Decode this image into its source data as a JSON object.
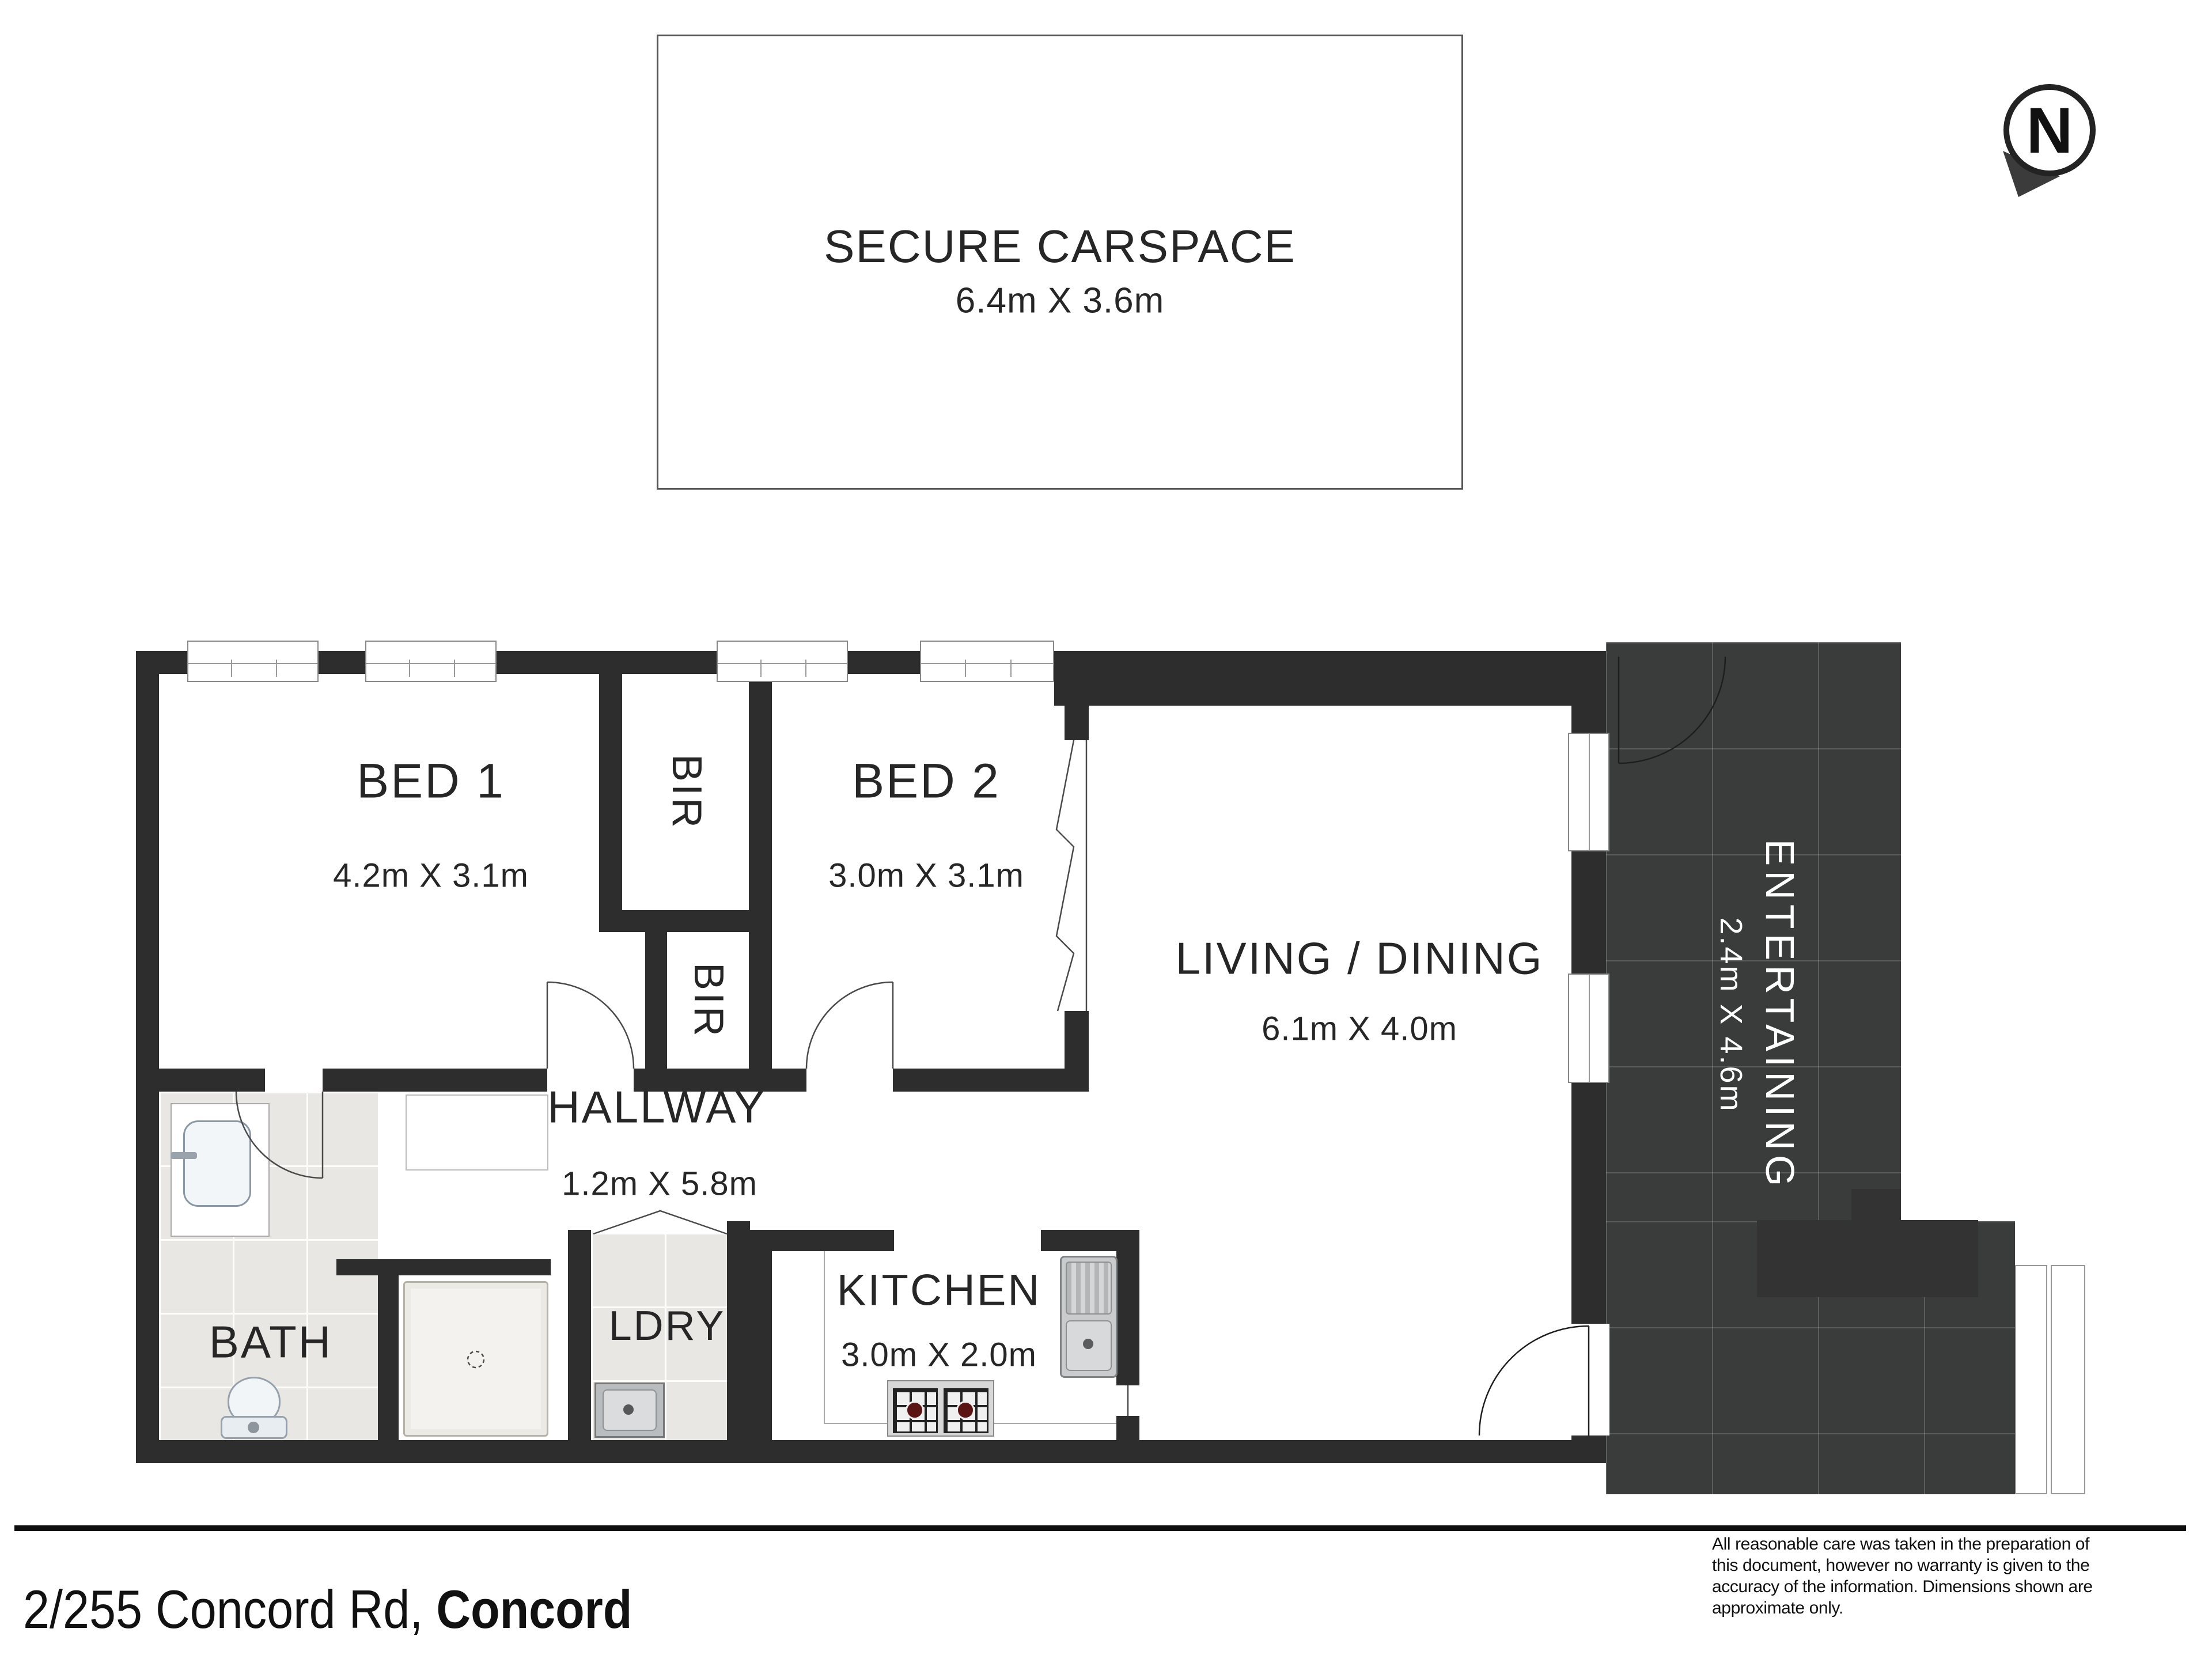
{
  "carspace": {
    "title": "SECURE CARSPACE",
    "dims": "6.4m X 3.6m"
  },
  "compass": {
    "letter": "N"
  },
  "rooms": {
    "bed1": {
      "label": "BED 1",
      "dims": "4.2m X 3.1m"
    },
    "bed2": {
      "label": "BED 2",
      "dims": "3.0m X 3.1m"
    },
    "living": {
      "label": "LIVING / DINING",
      "dims": "6.1m X 4.0m"
    },
    "hallway": {
      "label": "HALLWAY",
      "dims": "1.2m X 5.8m"
    },
    "kitchen": {
      "label": "KITCHEN",
      "dims": "3.0m X 2.0m"
    },
    "bath": {
      "label": "BATH"
    },
    "laundry": {
      "label": "LDRY"
    },
    "entertaining": {
      "label": "ENTERTAINING",
      "dims": "2.4m X 4.6m"
    },
    "bir_top": {
      "label": "BIR"
    },
    "bir_bottom": {
      "label": "BIR"
    }
  },
  "footer": {
    "address_main": "2/255 Concord Rd, ",
    "address_suburb": "Concord",
    "disclaimer_lines": [
      "All reasonable care was taken in the preparation of",
      "this document, however no warranty is given to the",
      "accuracy of the information. Dimensions shown are",
      "approximate only."
    ]
  },
  "colors": {
    "wall": "#2d2d2d",
    "dark_tile": "#3a3c3b",
    "light_tile": "#e8e7e4",
    "paper": "#ffffff",
    "label_text": "#262626",
    "entertaining_text": "#ffffff"
  }
}
